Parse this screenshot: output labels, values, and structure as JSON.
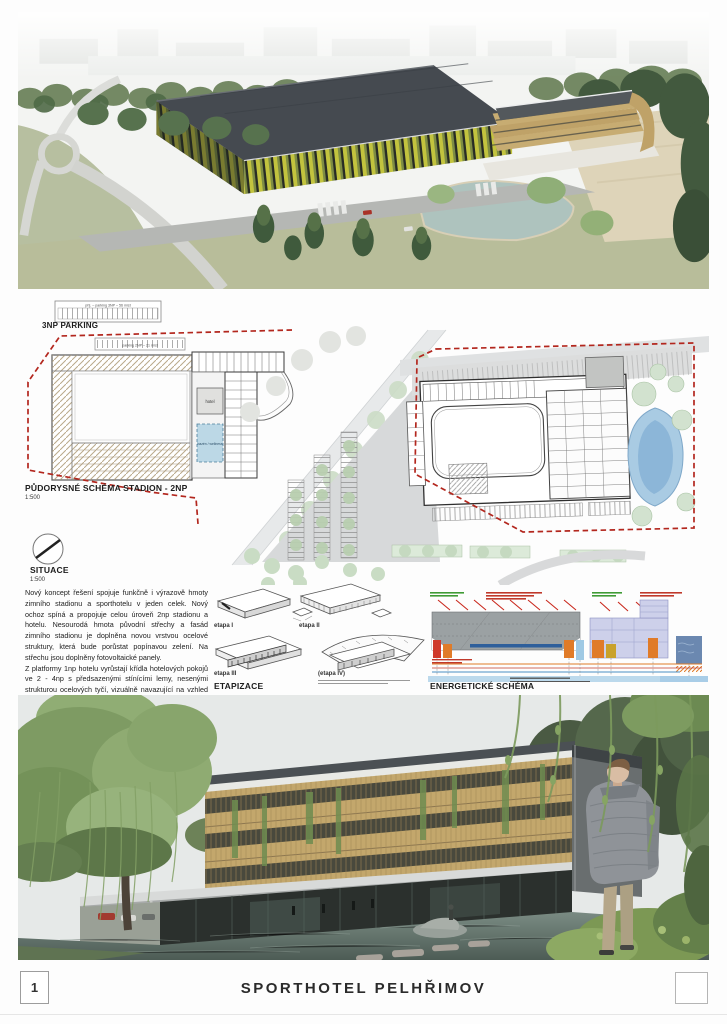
{
  "footer": {
    "page_number": "1",
    "title": "SPORTHOTEL PELHŘIMOV"
  },
  "stadium_plan": {
    "parking_heading": "3NP PARKING",
    "parking_roof_label": "příj. – parking 3NP – 56 míst",
    "parking_2np_label": "parking 2NP – 21 míst",
    "title": "PŮDORYSNÉ SCHÉMA STADION - 2NP",
    "scale": "1:500",
    "room_hotel": "hotel",
    "room_wellness": "bazén / wellness"
  },
  "site_plan": {
    "title": "SITUACE",
    "scale": "1:500"
  },
  "concept": {
    "paragraph_1": "Nový koncept řešení spojuje funkčně i výrazově hmoty zimního stadionu a sporthotelu v jeden celek. Nový ochoz spíná a propojuje celou úroveň 2np stadionu a hotelu. Nesourodá hmota původní střechy a fasád zimního stadionu je doplněna novou vrstvou ocelové struktury, která bude porůstat popínavou zelení. Na střechu jsou doplněny fotovoltaické panely.",
    "paragraph_2": "Z platformy 1np hotelu vyrůstají křídla hotelových pokojů ve 2 - 4np s předsazenými stínícími lemy, nesenými strukturou ocelových tyčí, vizuálně navazující na vzhled pláště stadionu."
  },
  "etapizace": {
    "heading": "ETAPIZACE",
    "stages": [
      "etapa I",
      "etapa II",
      "etapa III",
      "(etapa IV)"
    ]
  },
  "energy": {
    "heading": "ENERGETICKÉ SCHÉMA"
  },
  "colors": {
    "boundary_red": "#b3271e",
    "pond_blue": "#a9cbe3",
    "facade_yellow_green": "#c2c33e",
    "hotel_wood": "#c3a76c",
    "stadium_roof": "#454a50",
    "water_grey_green": "#6e7f77"
  }
}
